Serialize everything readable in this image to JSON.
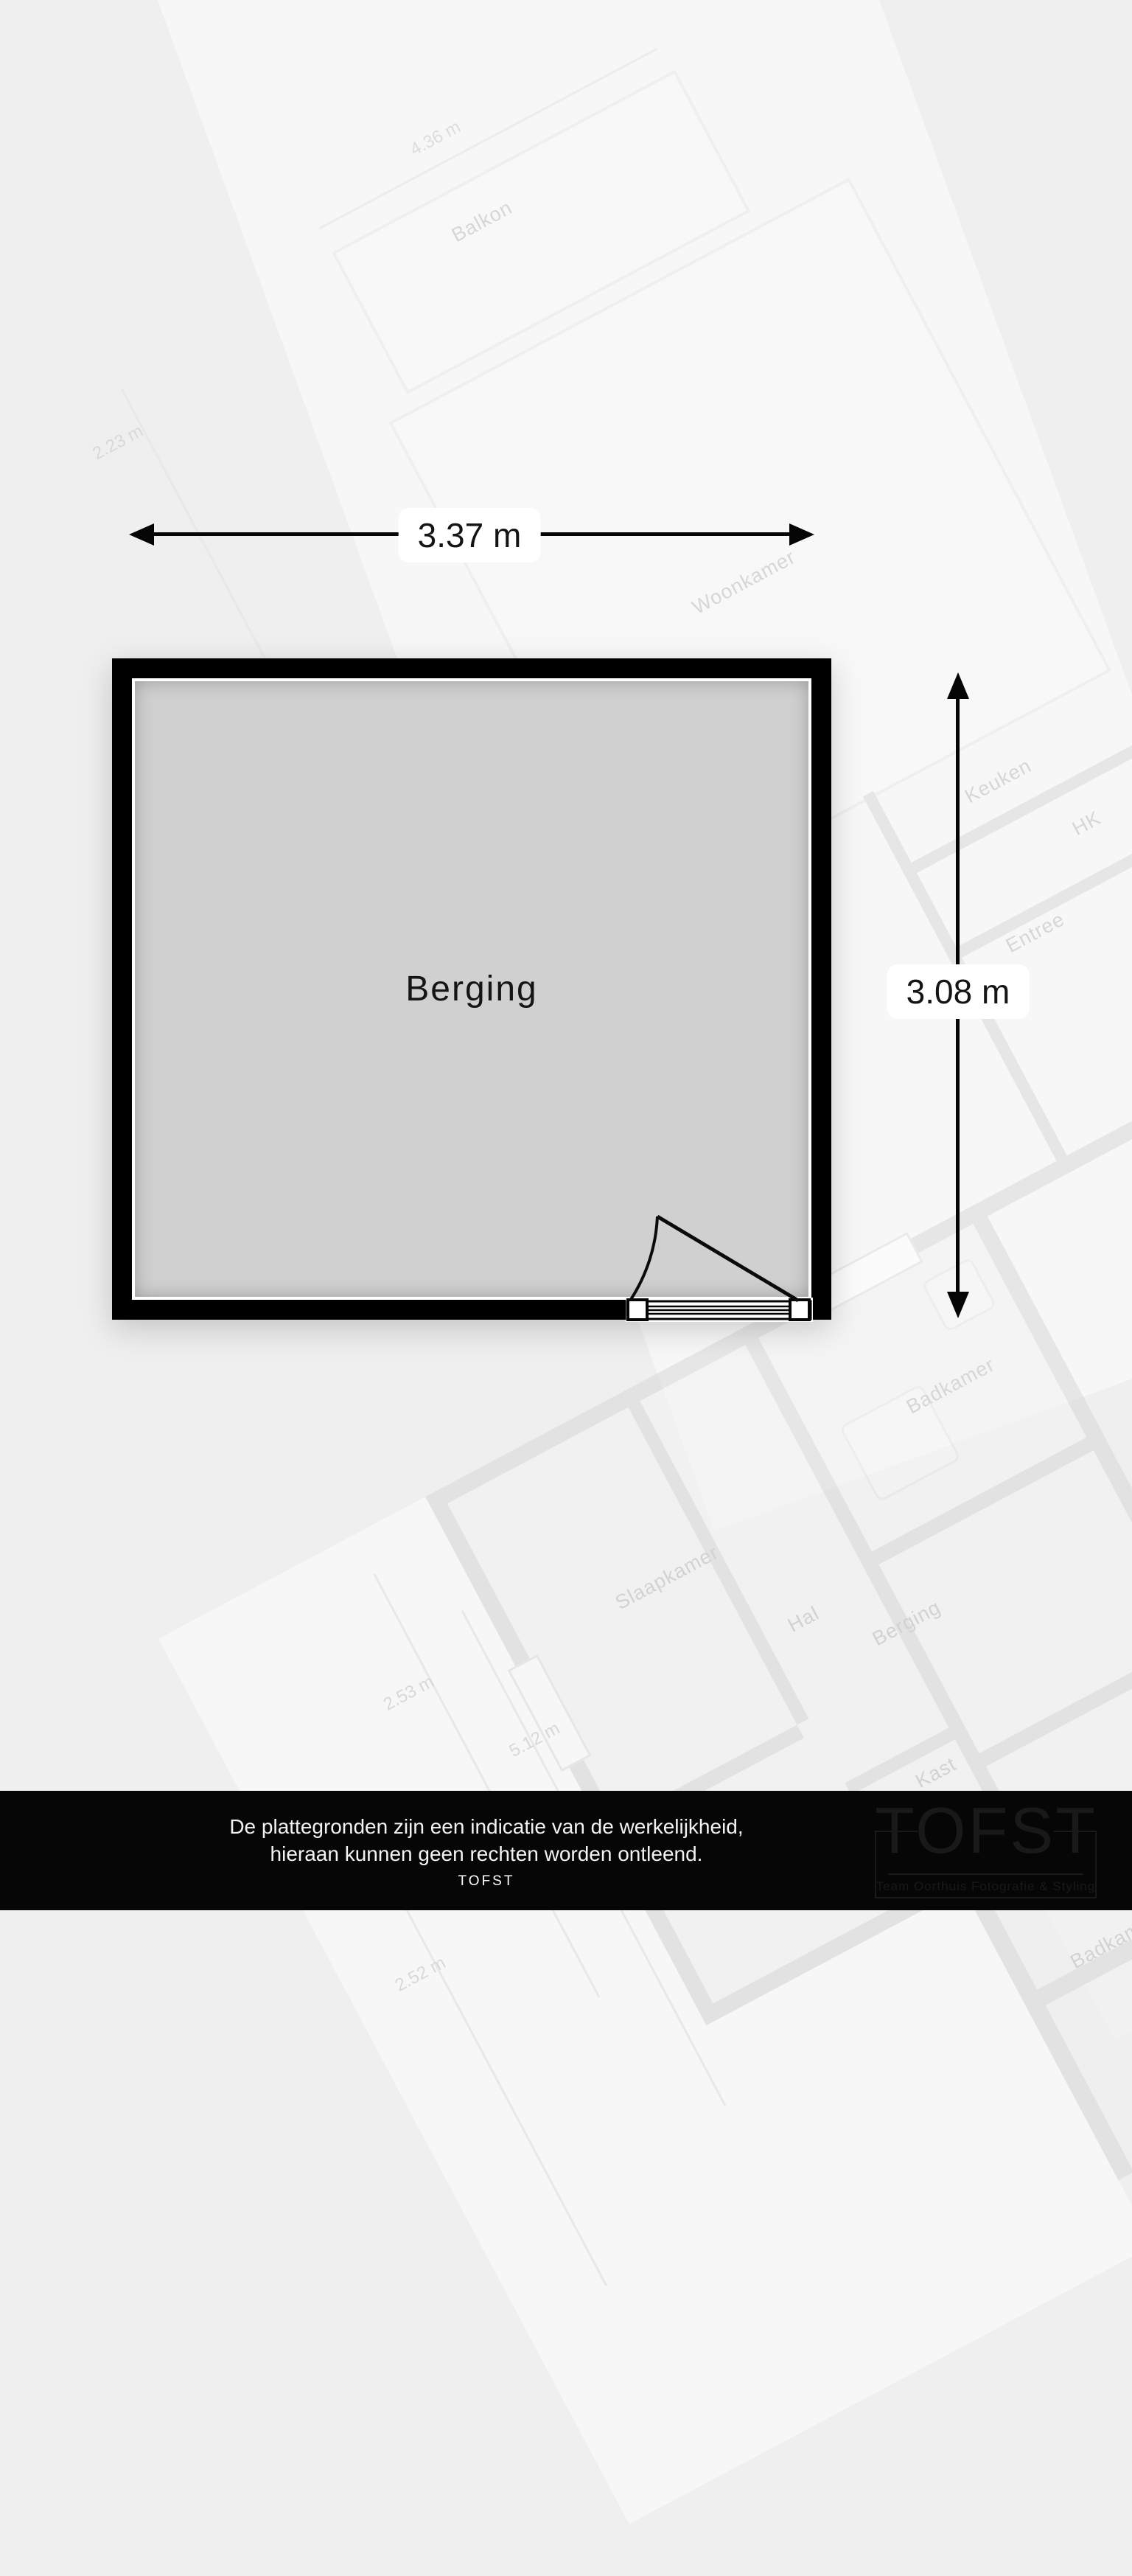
{
  "plan": {
    "room": {
      "label": "Berging"
    },
    "dimensions": {
      "width": "3.37 m",
      "height": "3.08 m"
    }
  },
  "background_plan": {
    "room_labels": [
      "Balkon",
      "Woonkamer",
      "Keuken",
      "HK",
      "Entree",
      "Badkamer",
      "Slaapkamer",
      "Hal",
      "Berging",
      "Kast",
      "Badkamer"
    ],
    "dimension_labels": [
      "4.36 m",
      "2.23 m",
      "2.53 m",
      "5.12 m",
      "2.52 m"
    ]
  },
  "footer": {
    "disclaimer_line1": "De plattegronden zijn een indicatie van de werkelijkheid,",
    "disclaimer_line2": "hieraan kunnen geen rechten worden ontleend.",
    "brand": "TOFST",
    "logo": {
      "title": "TOFST",
      "subtitle": "Team Oorthuis Fotografie & Styling"
    }
  },
  "colors": {
    "wall": "#000000",
    "floor": "#d0d0d0",
    "footer_bg": "#060606",
    "dim_label_bg": "#ffffff"
  }
}
